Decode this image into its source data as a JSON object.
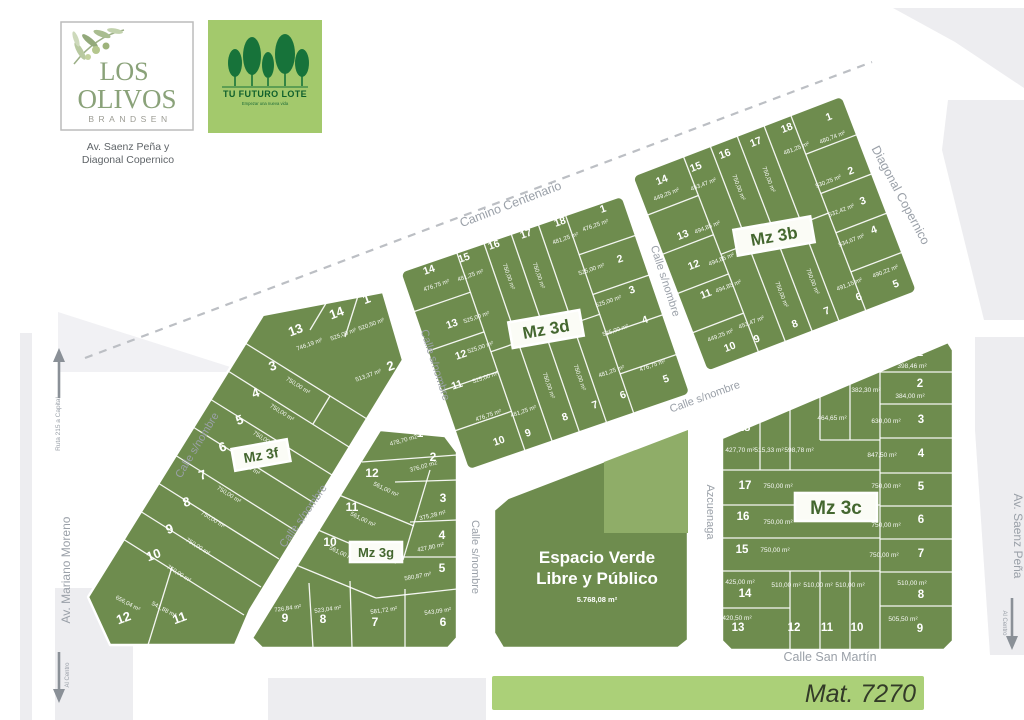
{
  "header": {
    "logo": {
      "line1": "LOS",
      "line2": "OLIVOS",
      "line3": "BRANDSEN",
      "address_line1": "Av. Saenz Peña y",
      "address_line2": "Diagonal Copernico"
    },
    "badge": {
      "title": "TU FUTURO LOTE",
      "tagline": "Empezar una nueva vida"
    }
  },
  "map": {
    "green_space": {
      "line1": "Espacio Verde",
      "line2": "Libre y Público",
      "area": "5.768,08 m²"
    },
    "streets": [
      {
        "id": "camino-centenario",
        "label": "Camino Centenario"
      },
      {
        "id": "diagonal-copernico",
        "label": "Diagonal Copernico"
      },
      {
        "id": "calle-sn-moreno-side",
        "label": "Calle s/nombre"
      },
      {
        "id": "calle-sn-3f-3g",
        "label": "Calle s/nombre"
      },
      {
        "id": "calle-sn-3g-east",
        "label": "Calle s/nombre"
      },
      {
        "id": "calle-sn-3f-3d",
        "label": "Calle s/nombre"
      },
      {
        "id": "calle-sn-3d-3b",
        "label": "Calle s/nombre"
      },
      {
        "id": "calle-sn-3d-south",
        "label": "Calle s/nombre"
      },
      {
        "id": "azcuenaga",
        "label": "Azcuenaga"
      },
      {
        "id": "av-saenz-pena",
        "label": "Av. Saenz Peña"
      },
      {
        "id": "av-mariano-moreno",
        "label": "Av. Mariano Moreno"
      },
      {
        "id": "ruta-215",
        "label": "Ruta 215 a Capital"
      },
      {
        "id": "al-centro-left",
        "label": "Al Centro"
      },
      {
        "id": "al-centro-right",
        "label": "Al Centro"
      },
      {
        "id": "calle-san-martin",
        "label": "Calle San Martín"
      }
    ],
    "blocks": [
      {
        "id": "mz3d",
        "label": "Mz 3d",
        "lots": [
          {
            "n": "1",
            "area": "476,25 m²"
          },
          {
            "n": "2",
            "area": "525,00 m²"
          },
          {
            "n": "3",
            "area": "525,00 m²"
          },
          {
            "n": "4",
            "area": "525,00 m²"
          },
          {
            "n": "5",
            "area": "476,75 m²"
          },
          {
            "n": "6",
            "area": "481,25 m²"
          },
          {
            "n": "7",
            "area": "750,00 m²"
          },
          {
            "n": "8",
            "area": "750,00 m²"
          },
          {
            "n": "9",
            "area": "481,25 m²"
          },
          {
            "n": "10",
            "area": "476,75 m²"
          },
          {
            "n": "11",
            "area": "525,00 m²"
          },
          {
            "n": "12",
            "area": "525,00 m²"
          },
          {
            "n": "13",
            "area": "525,00 m²"
          },
          {
            "n": "14",
            "area": "476,75 m²"
          },
          {
            "n": "15",
            "area": "481,25 m²"
          },
          {
            "n": "16",
            "area": "750,00 m²"
          },
          {
            "n": "17",
            "area": "750,00 m²"
          },
          {
            "n": "18",
            "area": "481,25 m²"
          }
        ]
      },
      {
        "id": "mz3b",
        "label": "Mz 3b",
        "lots": [
          {
            "n": "1",
            "area": "480,74 m²"
          },
          {
            "n": "2",
            "area": "530,25 m²"
          },
          {
            "n": "3",
            "area": "532,42 m²"
          },
          {
            "n": "4",
            "area": "534,67 m²"
          },
          {
            "n": "5",
            "area": "490,22 m²"
          },
          {
            "n": "6",
            "area": "491,15 m²"
          },
          {
            "n": "7",
            "area": "750,00 m²"
          },
          {
            "n": "8",
            "area": "750,00 m²"
          },
          {
            "n": "9",
            "area": "453,47 m²"
          },
          {
            "n": "10",
            "area": "449,25 m²"
          },
          {
            "n": "11",
            "area": "494,85 m²"
          },
          {
            "n": "12",
            "area": "494,85 m²"
          },
          {
            "n": "13",
            "area": "494,85 m²"
          },
          {
            "n": "14",
            "area": "449,25 m²"
          },
          {
            "n": "15",
            "area": "453,47 m²"
          },
          {
            "n": "16",
            "area": "750,00 m²"
          },
          {
            "n": "17",
            "area": "750,00 m²"
          },
          {
            "n": "18",
            "area": "481,25 m²"
          }
        ]
      },
      {
        "id": "mz3c",
        "label": "Mz 3c",
        "lots": [
          {
            "n": "1",
            "area": "398,46 m²"
          },
          {
            "n": "2",
            "area": "384,00 m²"
          },
          {
            "n": "3",
            "area": "630,00 m²"
          },
          {
            "n": "4",
            "area": "847,50 m²"
          },
          {
            "n": "5",
            "area": "750,00 m²"
          },
          {
            "n": "6",
            "area": "750,00 m²"
          },
          {
            "n": "7",
            "area": "750,00 m²"
          },
          {
            "n": "8",
            "area": "510,00 m²"
          },
          {
            "n": "9",
            "area": "505,50 m²"
          },
          {
            "n": "10",
            "area": "510,00 m²"
          },
          {
            "n": "11",
            "area": "510,00 m²"
          },
          {
            "n": "12",
            "area": "510,00 m²"
          },
          {
            "n": "13",
            "area": "420,50 m²"
          },
          {
            "n": "14",
            "area": "425,00 m²"
          },
          {
            "n": "15",
            "area": "750,00 m²"
          },
          {
            "n": "16",
            "area": "750,00 m²"
          },
          {
            "n": "17",
            "area": "750,00 m²"
          },
          {
            "n": "18",
            "area": "427,70 m²"
          },
          {
            "n": "19",
            "area": "515,33 m²"
          },
          {
            "n": "20",
            "area": "598,78 m²"
          },
          {
            "n": "21",
            "area": "464,65 m²"
          },
          {
            "n": "22",
            "area": "382,30 m²"
          }
        ]
      },
      {
        "id": "mz3f",
        "label": "Mz 3f",
        "lots": [
          {
            "n": "1",
            "area": "520,50 m²"
          },
          {
            "n": "2",
            "area": "513,37 m²"
          },
          {
            "n": "3",
            "area": "750,00 m²"
          },
          {
            "n": "4",
            "area": "750,00 m²"
          },
          {
            "n": "5",
            "area": "750,00 m²"
          },
          {
            "n": "6",
            "area": "750,00 m²"
          },
          {
            "n": "7",
            "area": "750,00 m²"
          },
          {
            "n": "8",
            "area": "750,00 m²"
          },
          {
            "n": "9",
            "area": "750,00 m²"
          },
          {
            "n": "10",
            "area": "750,00 m²"
          },
          {
            "n": "11",
            "area": "541,88 m²"
          },
          {
            "n": "12",
            "area": "656,04 m²"
          },
          {
            "n": "13",
            "area": "746,19 m²"
          },
          {
            "n": "14",
            "area": "525,00 m²"
          }
        ]
      },
      {
        "id": "mz3g",
        "label": "Mz 3g",
        "lots": [
          {
            "n": "1",
            "area": "478,70 m2"
          },
          {
            "n": "2",
            "area": "376,02 m2"
          },
          {
            "n": "3",
            "area": "375,28 m²"
          },
          {
            "n": "4",
            "area": "427,80 m²"
          },
          {
            "n": "5",
            "area": "580,87 m²"
          },
          {
            "n": "6",
            "area": "543,09 m²"
          },
          {
            "n": "7",
            "area": "581,72 m²"
          },
          {
            "n": "8",
            "area": "523,04 m²"
          },
          {
            "n": "9",
            "area": "726,84 m²"
          },
          {
            "n": "10",
            "area": "561,00 m²"
          },
          {
            "n": "11",
            "area": "561,00 m²"
          },
          {
            "n": "12",
            "area": "561,00 m²"
          }
        ]
      }
    ]
  },
  "footer": {
    "matricula": "Mat. 7270"
  },
  "colors": {
    "lot_green": "#6e8c4e",
    "light_green": "#8fad68",
    "banner_green": "#abd078",
    "badge_green": "#a3c96c",
    "tree_green": "#17733a",
    "street_gray": "#9aa0a8",
    "bg_gray": "#ededf0"
  }
}
